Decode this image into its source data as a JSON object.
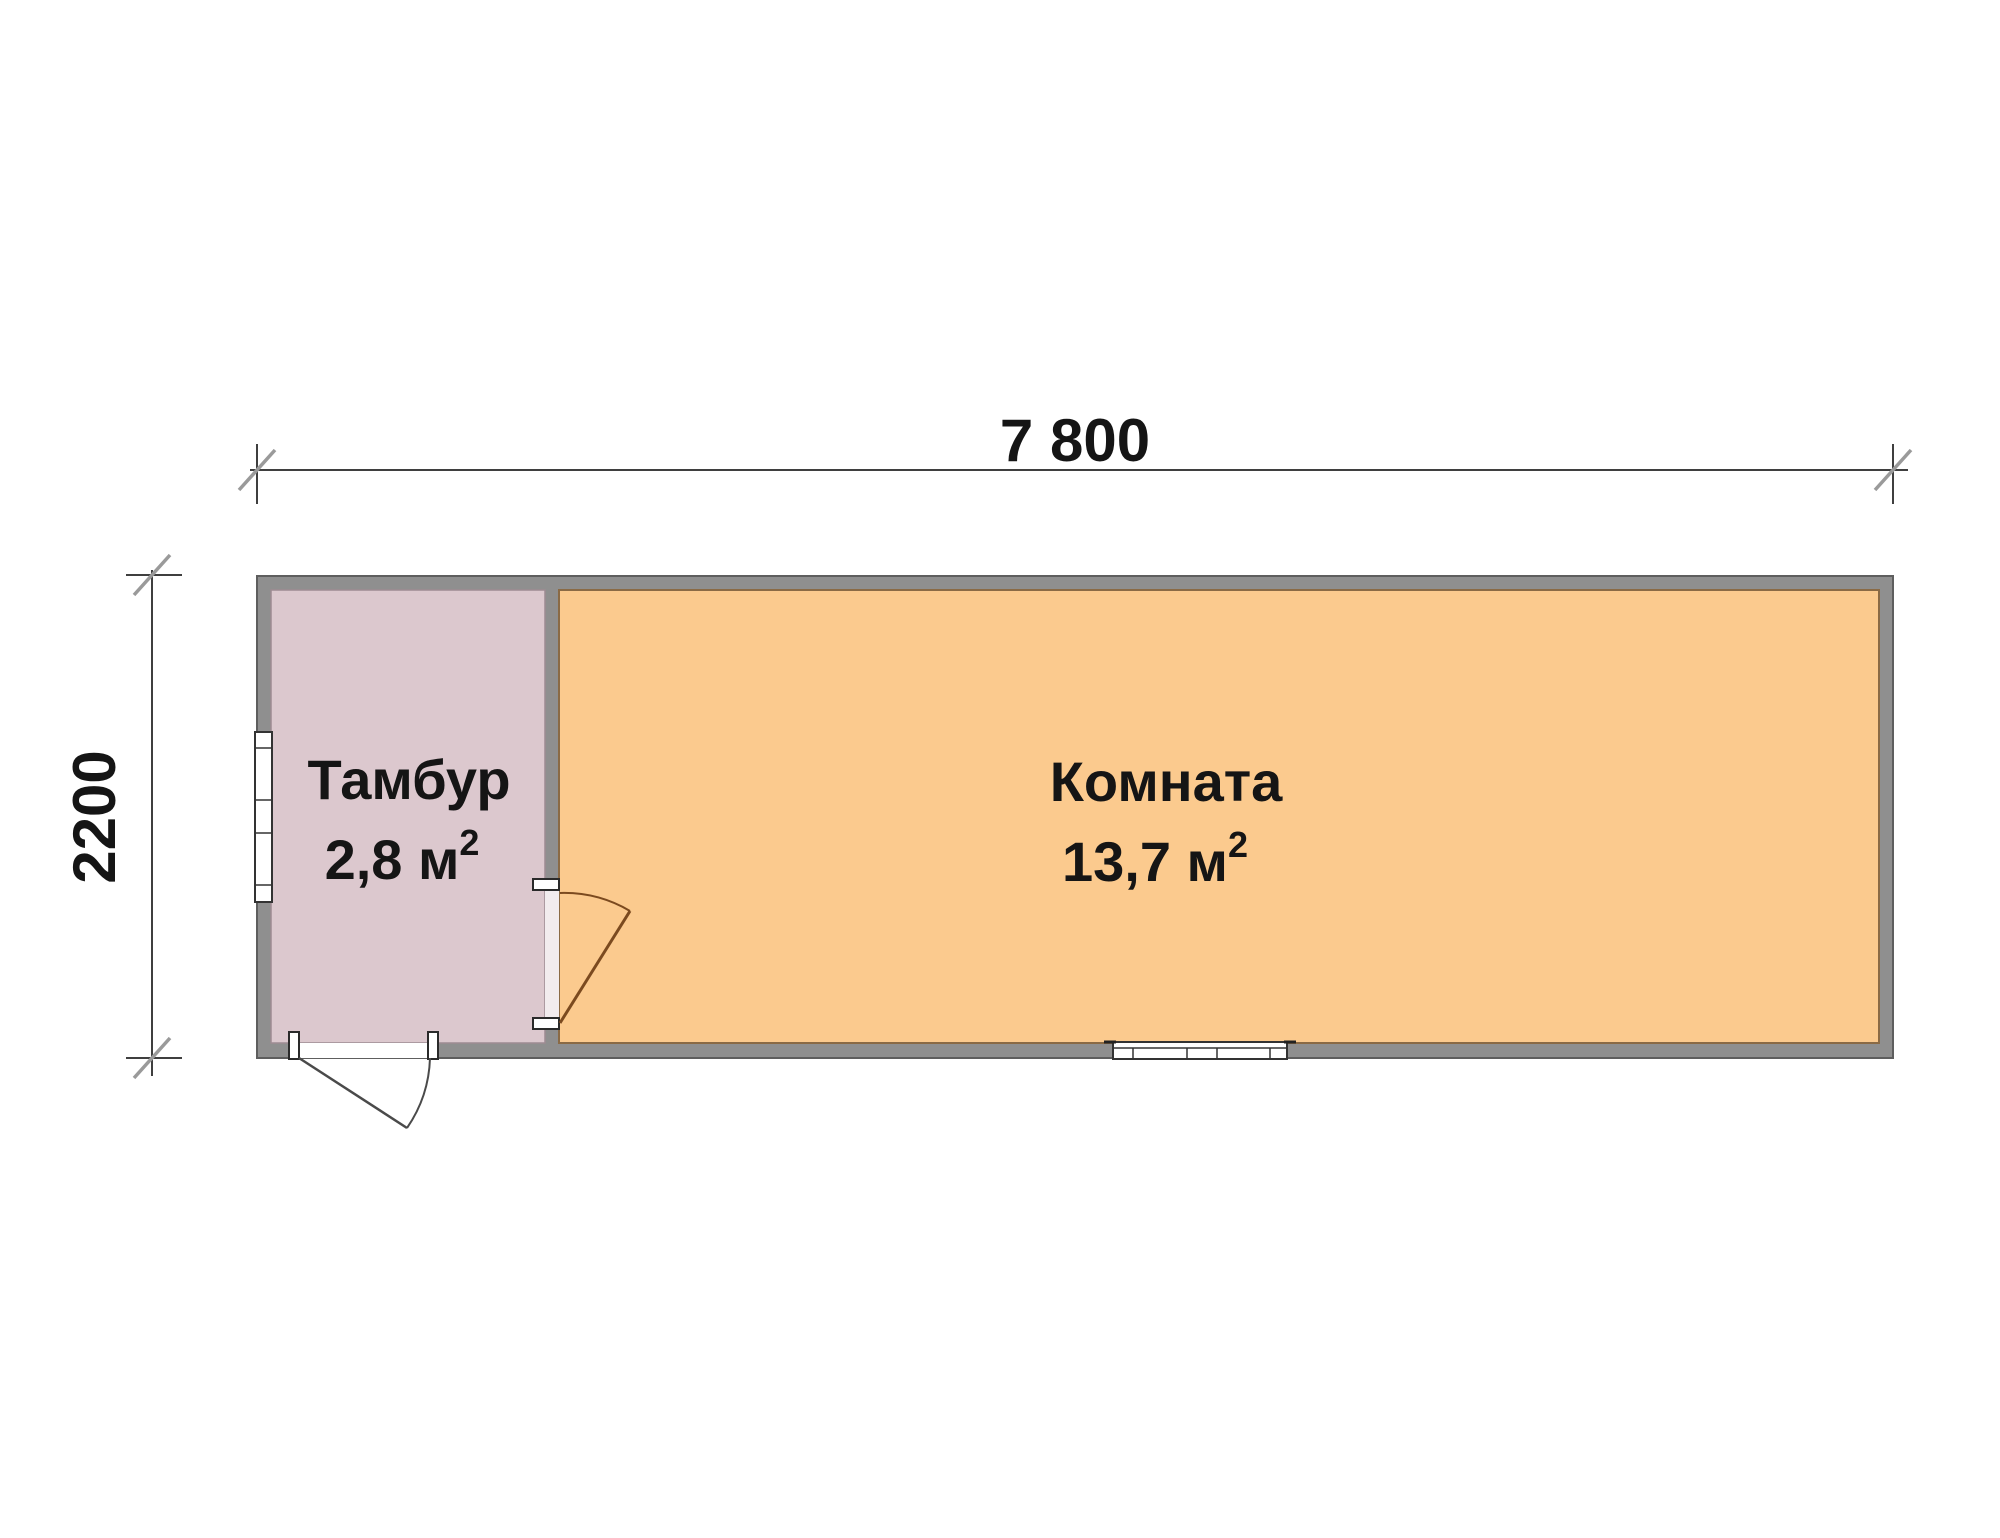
{
  "drawing": {
    "type": "floor-plan",
    "dimensions": {
      "width_label": "7 800",
      "height_label": "2200"
    },
    "rooms": {
      "tambur": {
        "name": "Тамбур",
        "area": "2,8 м",
        "area_sup": "2"
      },
      "komnata": {
        "name": "Комната",
        "area": "13,7 м",
        "area_sup": "2"
      }
    },
    "colors": {
      "wall_fill": "#8f8f8f",
      "wall_outline": "#5e5e5e",
      "tambur_fill": "#dcc8ce",
      "tambur_outline": "#9d8b92",
      "komnata_fill": "#fbca8e",
      "komnata_outline": "#8a6a45",
      "dim_line": "#3f3f3f",
      "dim_tick": "#9a9a9a",
      "interior_door": "#7b4a1f",
      "exterior_door": "#4a4a4a",
      "window_frame": "#333333",
      "text": "#151515"
    }
  }
}
